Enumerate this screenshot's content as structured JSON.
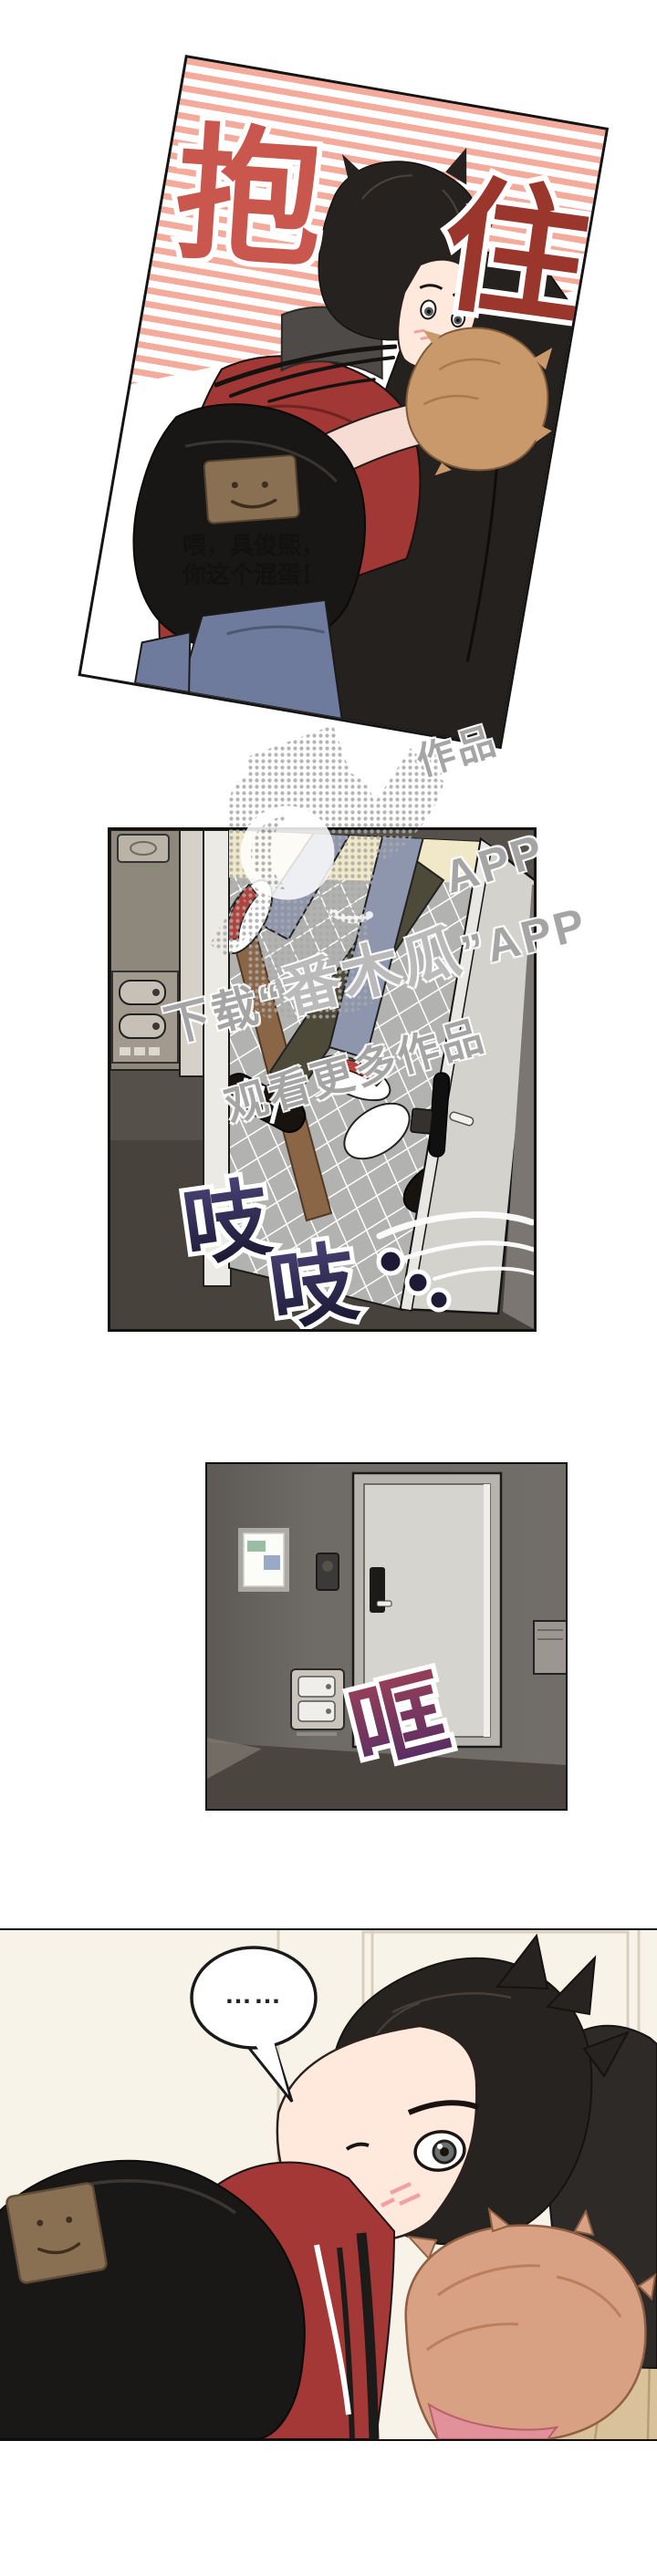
{
  "page": {
    "background": "#ffffff"
  },
  "panel1": {
    "title_char_left": "抱",
    "title_char_right": "住",
    "title_color_left": "#c9574d",
    "title_color_right": "#9a362c",
    "stripe_color": "#f5ab9b",
    "speech": {
      "line1": "喂，具俊熙，",
      "line2": "你这个混蛋！"
    }
  },
  "panel2": {
    "sfx": {
      "char1": "吱",
      "char2": "吱",
      "trail_dots": 3
    },
    "sfx_color_top": "#4a4377",
    "sfx_color_bottom": "#15132b"
  },
  "panel3": {
    "sfx_text": "哐",
    "sfx_color_top": "#9b4157",
    "sfx_color_bottom": "#4f2b66"
  },
  "panel4": {
    "bubble_text": "……"
  },
  "watermark": {
    "line1_prefix": "下载“",
    "line1_brand": "番木瓜",
    "line1_suffix": "”APP",
    "line2": "观看更多作品",
    "fragment_top": "作品",
    "fragment_app": "APP",
    "color": "#9a9a9a"
  }
}
